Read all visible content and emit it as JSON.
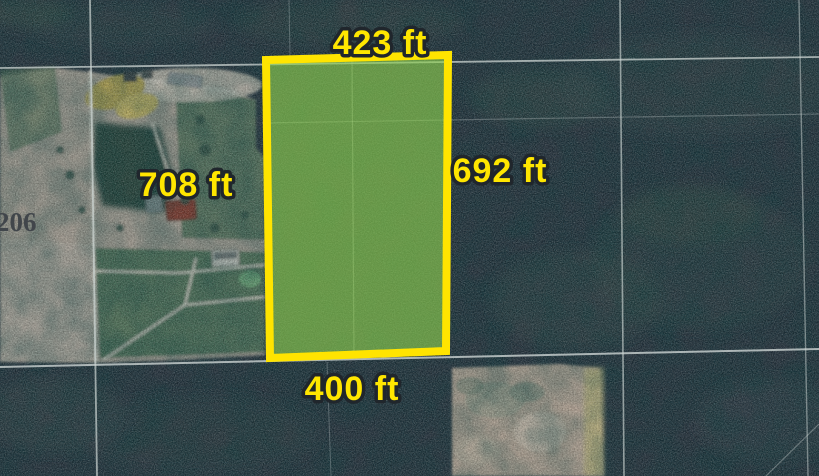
{
  "map": {
    "view_type": "satellite imagery with highlighted land parcel",
    "road_label": "206",
    "parcel": {
      "dimension_top": "423 ft",
      "dimension_right": "692 ft",
      "dimension_left": "708 ft",
      "dimension_bottom": "400 ft"
    },
    "colors": {
      "parcel_outline": "#FFE400",
      "parcel_fill": "#8FD24F",
      "dimension_text": "#FFE600",
      "dimension_outline": "#20262C",
      "road_label_text": "#41464B",
      "forest": "#283743",
      "cleared_land": "#B0A99E",
      "sand_clearing": "#C5B2A2",
      "gridline": "#CDD5D3"
    }
  }
}
